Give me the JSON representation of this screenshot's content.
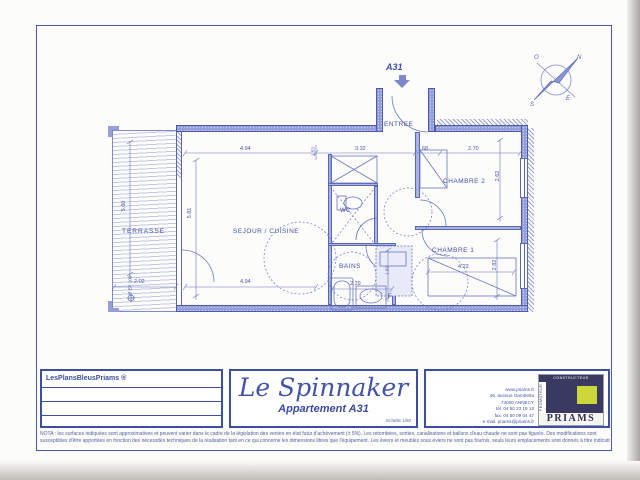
{
  "plan": {
    "unit_label": "A31",
    "rooms": {
      "terrasse": "TERRASSE",
      "sejour": "SEJOUR / CUISINE",
      "wc": "WC",
      "bains": "BAINS",
      "chambre2": "CHAMBRE 2",
      "chambre1": "CHAMBRE 1",
      "entree": "ENTREE"
    },
    "labels": {
      "fridge": "F",
      "drain": "Ø EP 100"
    },
    "dims": {
      "sejour_width_top": "4.94",
      "small_top": "1.53",
      "hall_width": "3.32",
      "closet_width": "68",
      "chambre2_width": "2.70",
      "chambre2_height": "2.62",
      "sejour_height": "5.81",
      "terrasse_height": "5.60",
      "terrasse_width": "2.02",
      "sejour_width_bottom": "4.94",
      "bains_width": "2.29",
      "bains_height": "1.92",
      "chambre1_width": "4.22",
      "chambre1_height": "2.82"
    },
    "compass": {
      "n": "N",
      "s": "S",
      "e": "E",
      "o": "O"
    }
  },
  "title_block": {
    "brand": "LesPlansBleusPriams ®",
    "residence": "Le Spinnaker",
    "apartment": "Appartement A31",
    "scale": "Echelle 1/50",
    "contact": [
      "www.priams.fr",
      "46, avenue Gambetta",
      "74000 ANNECY",
      "tél. 04 50 23 19 13",
      "fax. 04 50 09 04 47",
      "e-mail. priams@priams.fr"
    ],
    "logo": {
      "name": "PRIAMS",
      "promoteur": "PROMOTEUR",
      "constructeur": "CONSTRUCTEUR"
    }
  },
  "nota": {
    "line1": "NOTA : les surfaces indiquées sont approximatives et peuvent varier dans le cadre de la législation des ventes en état futur d'achèvement (± 5%). Les retombées, sorties, canalisations et ballons d'eau chaude ne sont pas figurés. Des modifications sont",
    "line2": "susceptibles d'être apportées en fonction des nécessités techniques de la réalisation tant en ce qui concerne les dimensions libres que l'équipement. Les éviers et meubles sous éviers ne sont pas fournis, seuls leurs emplacements sont donnés à titre indicatif."
  },
  "colors": {
    "line": "#5b67b5",
    "wall_fill": "#95a0d8",
    "text": "#4353a8",
    "logo_navy": "#3a3a60",
    "logo_yellow": "#ccd83a"
  }
}
